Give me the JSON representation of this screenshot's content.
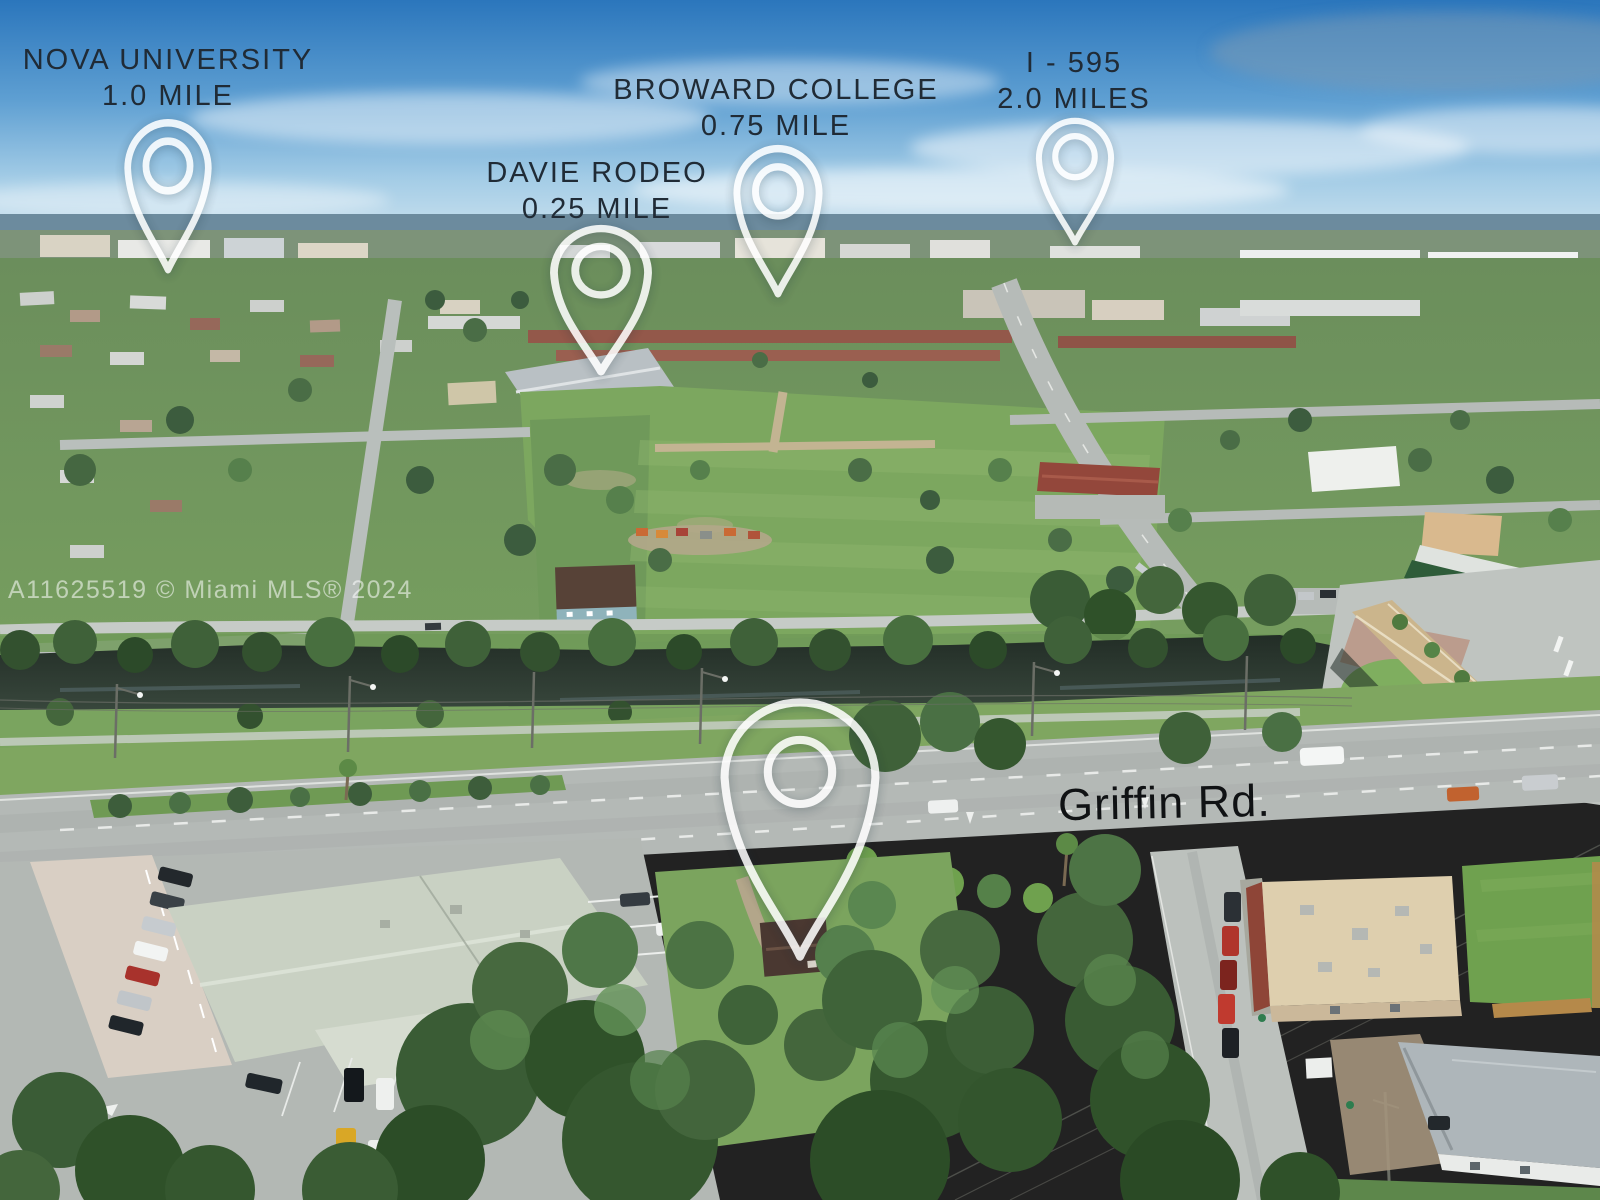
{
  "watermark": {
    "text": "A11625519 © Miami MLS® 2024"
  },
  "road_label": {
    "text": "Griffin Rd."
  },
  "markers": [
    {
      "id": "nova-university",
      "title": "NOVA UNIVERSITY",
      "distance": "1.0 MILE"
    },
    {
      "id": "davie-rodeo",
      "title": "DAVIE RODEO",
      "distance": "0.25 MILE"
    },
    {
      "id": "broward-college",
      "title": "BROWARD COLLEGE",
      "distance": "0.75 MILE"
    },
    {
      "id": "i-595",
      "title": "I - 595",
      "distance": "2.0 MILES"
    },
    {
      "id": "subject-property",
      "title": "",
      "distance": ""
    }
  ],
  "icons": {
    "map_pin": "teardrop-outline-with-ring"
  },
  "colors": {
    "label_text": "#202b36",
    "road_label_text": "#101214",
    "pin": "#ffffff",
    "watermark": "rgba(255,255,255,0.55)",
    "sky": "#2b76bc",
    "grass": "#79a15c",
    "water": "#2a352d",
    "road": "#b7bcb9"
  }
}
